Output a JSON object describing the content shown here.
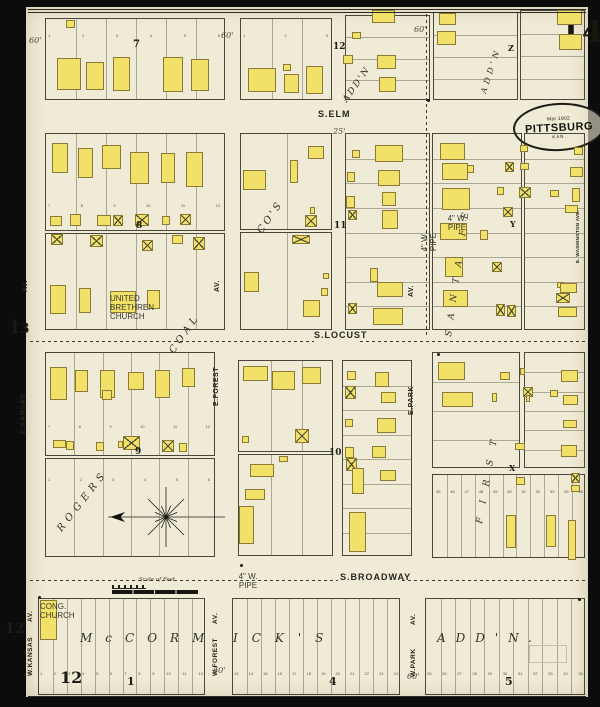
{
  "sheet": {
    "number": "14"
  },
  "stamp": {
    "date": "Mar.1902",
    "city": "PITTSBURG",
    "state": "KAN."
  },
  "scale": {
    "label": "Scale of Feet"
  },
  "colors": {
    "paper": "#f0ebd6",
    "building_fill": "#f2e169",
    "building_edge": "#8a7a35",
    "ink": "#23231c",
    "backdrop": "#0c0c0c"
  },
  "streets": [
    {
      "t": "S.ELM",
      "x": 318,
      "y": 110,
      "r": 0,
      "s": 9,
      "ls": 1
    },
    {
      "t": "S.LOCUST",
      "x": 314,
      "y": 331,
      "r": 0,
      "s": 9,
      "ls": 1
    },
    {
      "t": "S.BROADWAY",
      "x": 340,
      "y": 573,
      "r": 0,
      "s": 9,
      "ls": 1
    },
    {
      "t": "AV.",
      "x": 22,
      "y": 292,
      "r": -90,
      "s": 7,
      "ls": 0.5
    },
    {
      "t": "E.KANSAS",
      "x": 20,
      "y": 434,
      "r": -90,
      "s": 7,
      "ls": 0.5
    },
    {
      "t": "AV.",
      "x": 214,
      "y": 292,
      "r": -90,
      "s": 7,
      "ls": 0.5
    },
    {
      "t": "E.FOREST",
      "x": 213,
      "y": 406,
      "r": -90,
      "s": 7,
      "ls": 0.5
    },
    {
      "t": "AV.",
      "x": 408,
      "y": 297,
      "r": -90,
      "s": 7,
      "ls": 0.5
    },
    {
      "t": "E.PARK",
      "x": 408,
      "y": 415,
      "r": -90,
      "s": 7,
      "ls": 0.5
    },
    {
      "t": "AV.",
      "x": 28,
      "y": 622,
      "r": -90,
      "s": 6.5,
      "ls": 0.5
    },
    {
      "t": "W.KANSAS",
      "x": 28,
      "y": 676,
      "r": -90,
      "s": 6.5,
      "ls": 0.5
    },
    {
      "t": "AV.",
      "x": 213,
      "y": 624,
      "r": -90,
      "s": 6.5,
      "ls": 0.5
    },
    {
      "t": "W.FOREST",
      "x": 213,
      "y": 676,
      "r": -90,
      "s": 6.5,
      "ls": 0.5
    },
    {
      "t": "AV.",
      "x": 411,
      "y": 625,
      "r": -90,
      "s": 6.5,
      "ls": 0.5
    },
    {
      "t": "W.PARK",
      "x": 411,
      "y": 677,
      "r": -90,
      "s": 6.5,
      "ls": 0.5
    },
    {
      "t": "E. WASHINGTON AVE.",
      "x": 576,
      "y": 263,
      "r": -90,
      "s": 4.5,
      "ls": 0.3
    }
  ],
  "additions": [
    {
      "t": "ROGERS",
      "x": 56,
      "y": 528,
      "r": -52,
      "s": 10,
      "ls": 5
    },
    {
      "t": "COAL",
      "x": 168,
      "y": 350,
      "r": -55,
      "s": 10,
      "ls": 4
    },
    {
      "t": "CO'S",
      "x": 256,
      "y": 230,
      "r": -55,
      "s": 10,
      "ls": 3
    },
    {
      "t": "ADD'N",
      "x": 342,
      "y": 99,
      "r": -55,
      "s": 9,
      "ls": 2
    },
    {
      "t": "ADD'N",
      "x": 480,
      "y": 92,
      "r": -72,
      "s": 8,
      "ls": 4
    },
    {
      "t": "SANTA FE",
      "x": 445,
      "y": 336,
      "r": -82,
      "s": 9,
      "ls": 11
    },
    {
      "t": "FIRST",
      "x": 476,
      "y": 523,
      "r": -80,
      "s": 9,
      "ls": 14
    },
    {
      "t": "McCORM",
      "x": 80,
      "y": 632,
      "r": 0,
      "s": 12,
      "ls": 13
    },
    {
      "t": "ICK'S",
      "x": 233,
      "y": 632,
      "r": 0,
      "s": 12,
      "ls": 14
    },
    {
      "t": "ADD'N.",
      "x": 437,
      "y": 632,
      "r": 0,
      "s": 12,
      "ls": 10
    }
  ],
  "numbers": [
    {
      "t": "7",
      "x": 133,
      "y": 40,
      "s": 10
    },
    {
      "t": "12",
      "x": 333,
      "y": 43,
      "s": 9
    },
    {
      "t": "8",
      "x": 136,
      "y": 222,
      "s": 9
    },
    {
      "t": "11",
      "x": 334,
      "y": 222,
      "s": 9
    },
    {
      "t": "13",
      "x": 10,
      "y": 322,
      "s": 14
    },
    {
      "t": "9",
      "x": 135,
      "y": 448,
      "s": 9
    },
    {
      "t": "10",
      "x": 329,
      "y": 449,
      "s": 9
    },
    {
      "t": "12",
      "x": 5,
      "y": 622,
      "s": 14
    },
    {
      "t": "12",
      "x": 60,
      "y": 670,
      "s": 16
    },
    {
      "t": "1",
      "x": 127,
      "y": 676,
      "s": 11
    },
    {
      "t": "4",
      "x": 329,
      "y": 676,
      "s": 11
    },
    {
      "t": "5",
      "x": 505,
      "y": 676,
      "s": 11
    }
  ],
  "markers": [
    {
      "t": "Z",
      "x": 508,
      "y": 44
    },
    {
      "t": "Y",
      "x": 510,
      "y": 220
    },
    {
      "t": "X",
      "x": 509,
      "y": 464
    }
  ],
  "dims": [
    {
      "t": "60'",
      "x": 29,
      "y": 37
    },
    {
      "t": "60'",
      "x": 221,
      "y": 32
    },
    {
      "t": "60'",
      "x": 414,
      "y": 26
    },
    {
      "t": "25'",
      "x": 333,
      "y": 128
    },
    {
      "t": "60'",
      "x": 213,
      "y": 667
    },
    {
      "t": "60'",
      "x": 407,
      "y": 673
    }
  ],
  "tiny_labels": [
    {
      "t": "UNITED\nBRETHREN\nCHURCH",
      "x": 110,
      "y": 294,
      "w": 26,
      "r": 0
    },
    {
      "t": "CONG.\nCHURCH",
      "x": 40,
      "y": 602,
      "w": 17,
      "r": 0
    },
    {
      "t": "4\" W. PIPE",
      "x": 447,
      "y": 214,
      "w": 20,
      "r": 0
    },
    {
      "t": "4\" W. PIPE",
      "x": 420,
      "y": 252,
      "w": 20,
      "r": -90
    },
    {
      "t": "4\" W. PIPE",
      "x": 238,
      "y": 572,
      "w": 20,
      "r": 0
    }
  ],
  "blocks": [
    [
      45,
      18,
      180,
      82,
      6,
      "v"
    ],
    [
      240,
      18,
      92,
      82,
      3,
      "v"
    ],
    [
      345,
      15,
      85,
      85,
      4,
      "h"
    ],
    [
      433,
      12,
      85,
      88,
      4,
      "h"
    ],
    [
      520,
      10,
      65,
      90,
      4,
      "h"
    ],
    [
      45,
      133,
      180,
      98,
      6,
      "v"
    ],
    [
      45,
      233,
      180,
      97,
      6,
      "v"
    ],
    [
      240,
      133,
      92,
      97,
      2,
      "v"
    ],
    [
      240,
      232,
      92,
      98,
      2,
      "v"
    ],
    [
      345,
      133,
      85,
      197,
      8,
      "h"
    ],
    [
      432,
      133,
      90,
      197,
      8,
      "h"
    ],
    [
      524,
      133,
      61,
      197,
      8,
      "h"
    ],
    [
      45,
      352,
      170,
      104,
      6,
      "v"
    ],
    [
      45,
      458,
      170,
      99,
      6,
      "v"
    ],
    [
      238,
      360,
      95,
      92,
      3,
      "v"
    ],
    [
      238,
      454,
      95,
      102,
      3,
      "v"
    ],
    [
      342,
      360,
      70,
      196,
      8,
      "h"
    ],
    [
      432,
      352,
      88,
      116,
      4,
      "h"
    ],
    [
      524,
      352,
      61,
      116,
      6,
      "h"
    ],
    [
      432,
      474,
      153,
      84,
      11,
      "v"
    ],
    [
      38,
      598,
      167,
      97,
      12,
      "v"
    ],
    [
      232,
      598,
      168,
      97,
      12,
      "v"
    ],
    [
      425,
      598,
      160,
      97,
      11,
      "v"
    ]
  ],
  "buildings": [
    [
      57,
      58,
      24,
      32,
      1
    ],
    [
      66,
      20,
      9,
      8,
      1
    ],
    [
      86,
      62,
      18,
      28,
      1
    ],
    [
      113,
      57,
      17,
      34,
      1
    ],
    [
      163,
      57,
      20,
      35,
      1
    ],
    [
      191,
      59,
      18,
      32,
      1
    ],
    [
      248,
      68,
      28,
      24,
      1
    ],
    [
      284,
      74,
      15,
      19,
      1
    ],
    [
      283,
      64,
      8,
      7,
      1
    ],
    [
      306,
      66,
      17,
      28,
      1
    ],
    [
      372,
      10,
      23,
      13,
      1
    ],
    [
      352,
      32,
      9,
      7,
      1
    ],
    [
      343,
      55,
      10,
      9,
      1
    ],
    [
      377,
      55,
      19,
      14,
      1
    ],
    [
      379,
      77,
      17,
      15,
      1
    ],
    [
      439,
      13,
      17,
      12,
      1
    ],
    [
      437,
      31,
      19,
      14,
      1
    ],
    [
      557,
      10,
      25,
      15,
      1
    ],
    [
      559,
      34,
      23,
      16,
      1
    ],
    [
      52,
      143,
      16,
      30,
      1
    ],
    [
      78,
      148,
      15,
      30,
      1
    ],
    [
      102,
      145,
      19,
      24,
      1
    ],
    [
      130,
      152,
      19,
      32,
      1
    ],
    [
      161,
      153,
      14,
      30,
      1
    ],
    [
      186,
      152,
      17,
      35,
      1
    ],
    [
      50,
      216,
      12,
      10,
      1
    ],
    [
      70,
      214,
      11,
      12,
      1
    ],
    [
      97,
      215,
      14,
      11,
      1
    ],
    [
      113,
      215,
      10,
      11,
      2
    ],
    [
      135,
      214,
      14,
      12,
      2
    ],
    [
      162,
      216,
      8,
      9,
      1
    ],
    [
      180,
      214,
      11,
      11,
      2
    ],
    [
      51,
      234,
      12,
      11,
      2
    ],
    [
      90,
      235,
      13,
      12,
      2
    ],
    [
      142,
      240,
      11,
      11,
      2
    ],
    [
      172,
      235,
      11,
      9,
      1
    ],
    [
      193,
      237,
      12,
      13,
      2
    ],
    [
      50,
      285,
      16,
      29,
      1
    ],
    [
      79,
      288,
      12,
      25,
      1
    ],
    [
      110,
      291,
      26,
      22,
      1
    ],
    [
      147,
      290,
      13,
      19,
      1
    ],
    [
      308,
      146,
      16,
      13,
      1
    ],
    [
      290,
      160,
      8,
      23,
      1
    ],
    [
      243,
      170,
      23,
      20,
      1
    ],
    [
      305,
      215,
      12,
      12,
      2
    ],
    [
      310,
      207,
      5,
      7,
      1
    ],
    [
      292,
      235,
      18,
      9,
      2
    ],
    [
      244,
      272,
      15,
      20,
      1
    ],
    [
      303,
      300,
      17,
      17,
      1
    ],
    [
      321,
      288,
      7,
      8,
      1
    ],
    [
      323,
      273,
      6,
      6,
      1
    ],
    [
      375,
      145,
      28,
      17,
      1
    ],
    [
      352,
      150,
      8,
      8,
      1
    ],
    [
      378,
      170,
      22,
      16,
      1
    ],
    [
      347,
      172,
      8,
      10,
      1
    ],
    [
      382,
      192,
      14,
      14,
      1
    ],
    [
      346,
      196,
      9,
      12,
      1
    ],
    [
      348,
      210,
      9,
      10,
      2
    ],
    [
      382,
      210,
      16,
      19,
      1
    ],
    [
      370,
      268,
      8,
      14,
      1
    ],
    [
      377,
      282,
      26,
      15,
      1
    ],
    [
      348,
      303,
      9,
      11,
      2
    ],
    [
      373,
      308,
      30,
      17,
      1
    ],
    [
      440,
      143,
      25,
      17,
      1
    ],
    [
      442,
      163,
      26,
      17,
      1
    ],
    [
      467,
      165,
      7,
      8,
      1
    ],
    [
      442,
      188,
      28,
      22,
      1
    ],
    [
      440,
      223,
      27,
      17,
      1
    ],
    [
      445,
      257,
      18,
      20,
      1
    ],
    [
      443,
      290,
      25,
      17,
      1
    ],
    [
      505,
      162,
      9,
      10,
      2
    ],
    [
      497,
      187,
      7,
      8,
      1
    ],
    [
      503,
      207,
      10,
      10,
      2
    ],
    [
      480,
      230,
      8,
      10,
      1
    ],
    [
      492,
      262,
      10,
      10,
      2
    ],
    [
      496,
      304,
      9,
      12,
      2
    ],
    [
      507,
      305,
      9,
      12,
      2
    ],
    [
      520,
      145,
      8,
      7,
      1
    ],
    [
      520,
      163,
      9,
      7,
      1
    ],
    [
      519,
      187,
      12,
      11,
      2
    ],
    [
      550,
      190,
      9,
      7,
      1
    ],
    [
      574,
      147,
      9,
      8,
      1
    ],
    [
      570,
      167,
      13,
      10,
      1
    ],
    [
      572,
      188,
      8,
      14,
      1
    ],
    [
      565,
      205,
      13,
      8,
      1
    ],
    [
      557,
      282,
      7,
      6,
      1
    ],
    [
      560,
      283,
      17,
      10,
      1
    ],
    [
      556,
      293,
      14,
      10,
      2
    ],
    [
      558,
      307,
      19,
      10,
      1
    ],
    [
      50,
      367,
      17,
      33,
      1
    ],
    [
      75,
      370,
      13,
      22,
      1
    ],
    [
      100,
      370,
      15,
      28,
      1
    ],
    [
      128,
      372,
      16,
      18,
      1
    ],
    [
      155,
      370,
      15,
      28,
      1
    ],
    [
      182,
      368,
      13,
      19,
      1
    ],
    [
      102,
      390,
      10,
      10,
      1
    ],
    [
      53,
      440,
      13,
      8,
      1
    ],
    [
      66,
      441,
      8,
      9,
      1
    ],
    [
      96,
      442,
      8,
      9,
      1
    ],
    [
      118,
      441,
      5,
      7,
      1
    ],
    [
      123,
      436,
      17,
      14,
      2
    ],
    [
      162,
      440,
      12,
      12,
      2
    ],
    [
      179,
      443,
      8,
      9,
      1
    ],
    [
      243,
      366,
      25,
      15,
      1
    ],
    [
      272,
      371,
      23,
      19,
      1
    ],
    [
      302,
      367,
      19,
      17,
      1
    ],
    [
      242,
      436,
      7,
      7,
      1
    ],
    [
      295,
      429,
      14,
      14,
      2
    ],
    [
      279,
      456,
      9,
      6,
      1
    ],
    [
      250,
      464,
      24,
      13,
      1
    ],
    [
      245,
      489,
      20,
      11,
      1
    ],
    [
      239,
      506,
      15,
      38,
      1
    ],
    [
      347,
      371,
      9,
      9,
      1
    ],
    [
      345,
      386,
      11,
      13,
      2
    ],
    [
      375,
      372,
      14,
      15,
      1
    ],
    [
      381,
      392,
      15,
      11,
      1
    ],
    [
      345,
      419,
      8,
      8,
      1
    ],
    [
      377,
      418,
      19,
      15,
      1
    ],
    [
      345,
      447,
      9,
      11,
      1
    ],
    [
      346,
      458,
      11,
      13,
      2
    ],
    [
      372,
      446,
      14,
      12,
      1
    ],
    [
      380,
      470,
      16,
      11,
      1
    ],
    [
      352,
      468,
      12,
      26,
      1
    ],
    [
      349,
      512,
      17,
      40,
      1
    ],
    [
      438,
      362,
      27,
      18,
      1
    ],
    [
      442,
      392,
      31,
      15,
      1
    ],
    [
      492,
      393,
      5,
      9,
      1
    ],
    [
      500,
      372,
      10,
      8,
      1
    ],
    [
      520,
      368,
      5,
      7,
      1
    ],
    [
      523,
      387,
      10,
      10,
      2
    ],
    [
      526,
      395,
      4,
      7,
      1
    ],
    [
      550,
      390,
      8,
      7,
      1
    ],
    [
      561,
      370,
      17,
      12,
      1
    ],
    [
      563,
      395,
      15,
      10,
      1
    ],
    [
      563,
      420,
      14,
      8,
      1
    ],
    [
      515,
      443,
      10,
      7,
      1
    ],
    [
      561,
      445,
      16,
      12,
      1
    ],
    [
      516,
      477,
      9,
      8,
      1
    ],
    [
      506,
      515,
      10,
      33,
      1
    ],
    [
      546,
      515,
      10,
      32,
      1
    ],
    [
      568,
      520,
      8,
      40,
      1
    ],
    [
      571,
      473,
      9,
      10,
      2
    ],
    [
      571,
      485,
      9,
      7,
      1
    ],
    [
      40,
      600,
      17,
      40,
      1
    ]
  ],
  "dashes": [
    [
      30,
      341,
      284,
      "h"
    ],
    [
      360,
      341,
      226,
      "h"
    ],
    [
      30,
      580,
      308,
      "h"
    ],
    [
      402,
      580,
      184,
      "h"
    ],
    [
      426,
      14,
      324,
      "v"
    ]
  ],
  "rules": [
    [
      28,
      9,
      558,
      "h"
    ],
    [
      28,
      12,
      558,
      "h"
    ],
    [
      28,
      696,
      558,
      "h"
    ]
  ],
  "dots": [
    [
      13,
      319
    ],
    [
      240,
      564
    ],
    [
      437,
      353
    ],
    [
      578,
      598
    ],
    [
      427,
      99
    ],
    [
      38,
      596
    ]
  ],
  "faint_rects": [
    [
      529,
      645,
      36,
      16
    ]
  ],
  "lot_rows": [
    {
      "x": 48,
      "y": 33,
      "w": 172,
      "t": "1 2 3 4 5 6"
    },
    {
      "x": 243,
      "y": 33,
      "w": 85,
      "t": "1 2 3"
    },
    {
      "x": 48,
      "y": 203,
      "w": 172,
      "t": "7 8 9 10 11 12"
    },
    {
      "x": 48,
      "y": 424,
      "w": 162,
      "t": "7 8 9 10 11 12"
    },
    {
      "x": 48,
      "y": 477,
      "w": 162,
      "t": "1 2 3 4 5 6"
    },
    {
      "x": 40,
      "y": 671,
      "w": 163,
      "t": "1 2 3 4 5 6 7 8 9 10 11 12"
    },
    {
      "x": 234,
      "y": 671,
      "w": 164,
      "t": "13 14 15 16 17 18 19 20 21 22 23 24"
    },
    {
      "x": 427,
      "y": 671,
      "w": 156,
      "t": "25 26 27 28 29 30 31 32 33 34 35"
    },
    {
      "x": 436,
      "y": 489,
      "w": 147,
      "t": "45 46 47 48 49 50 51 52 53 54 55"
    }
  ]
}
